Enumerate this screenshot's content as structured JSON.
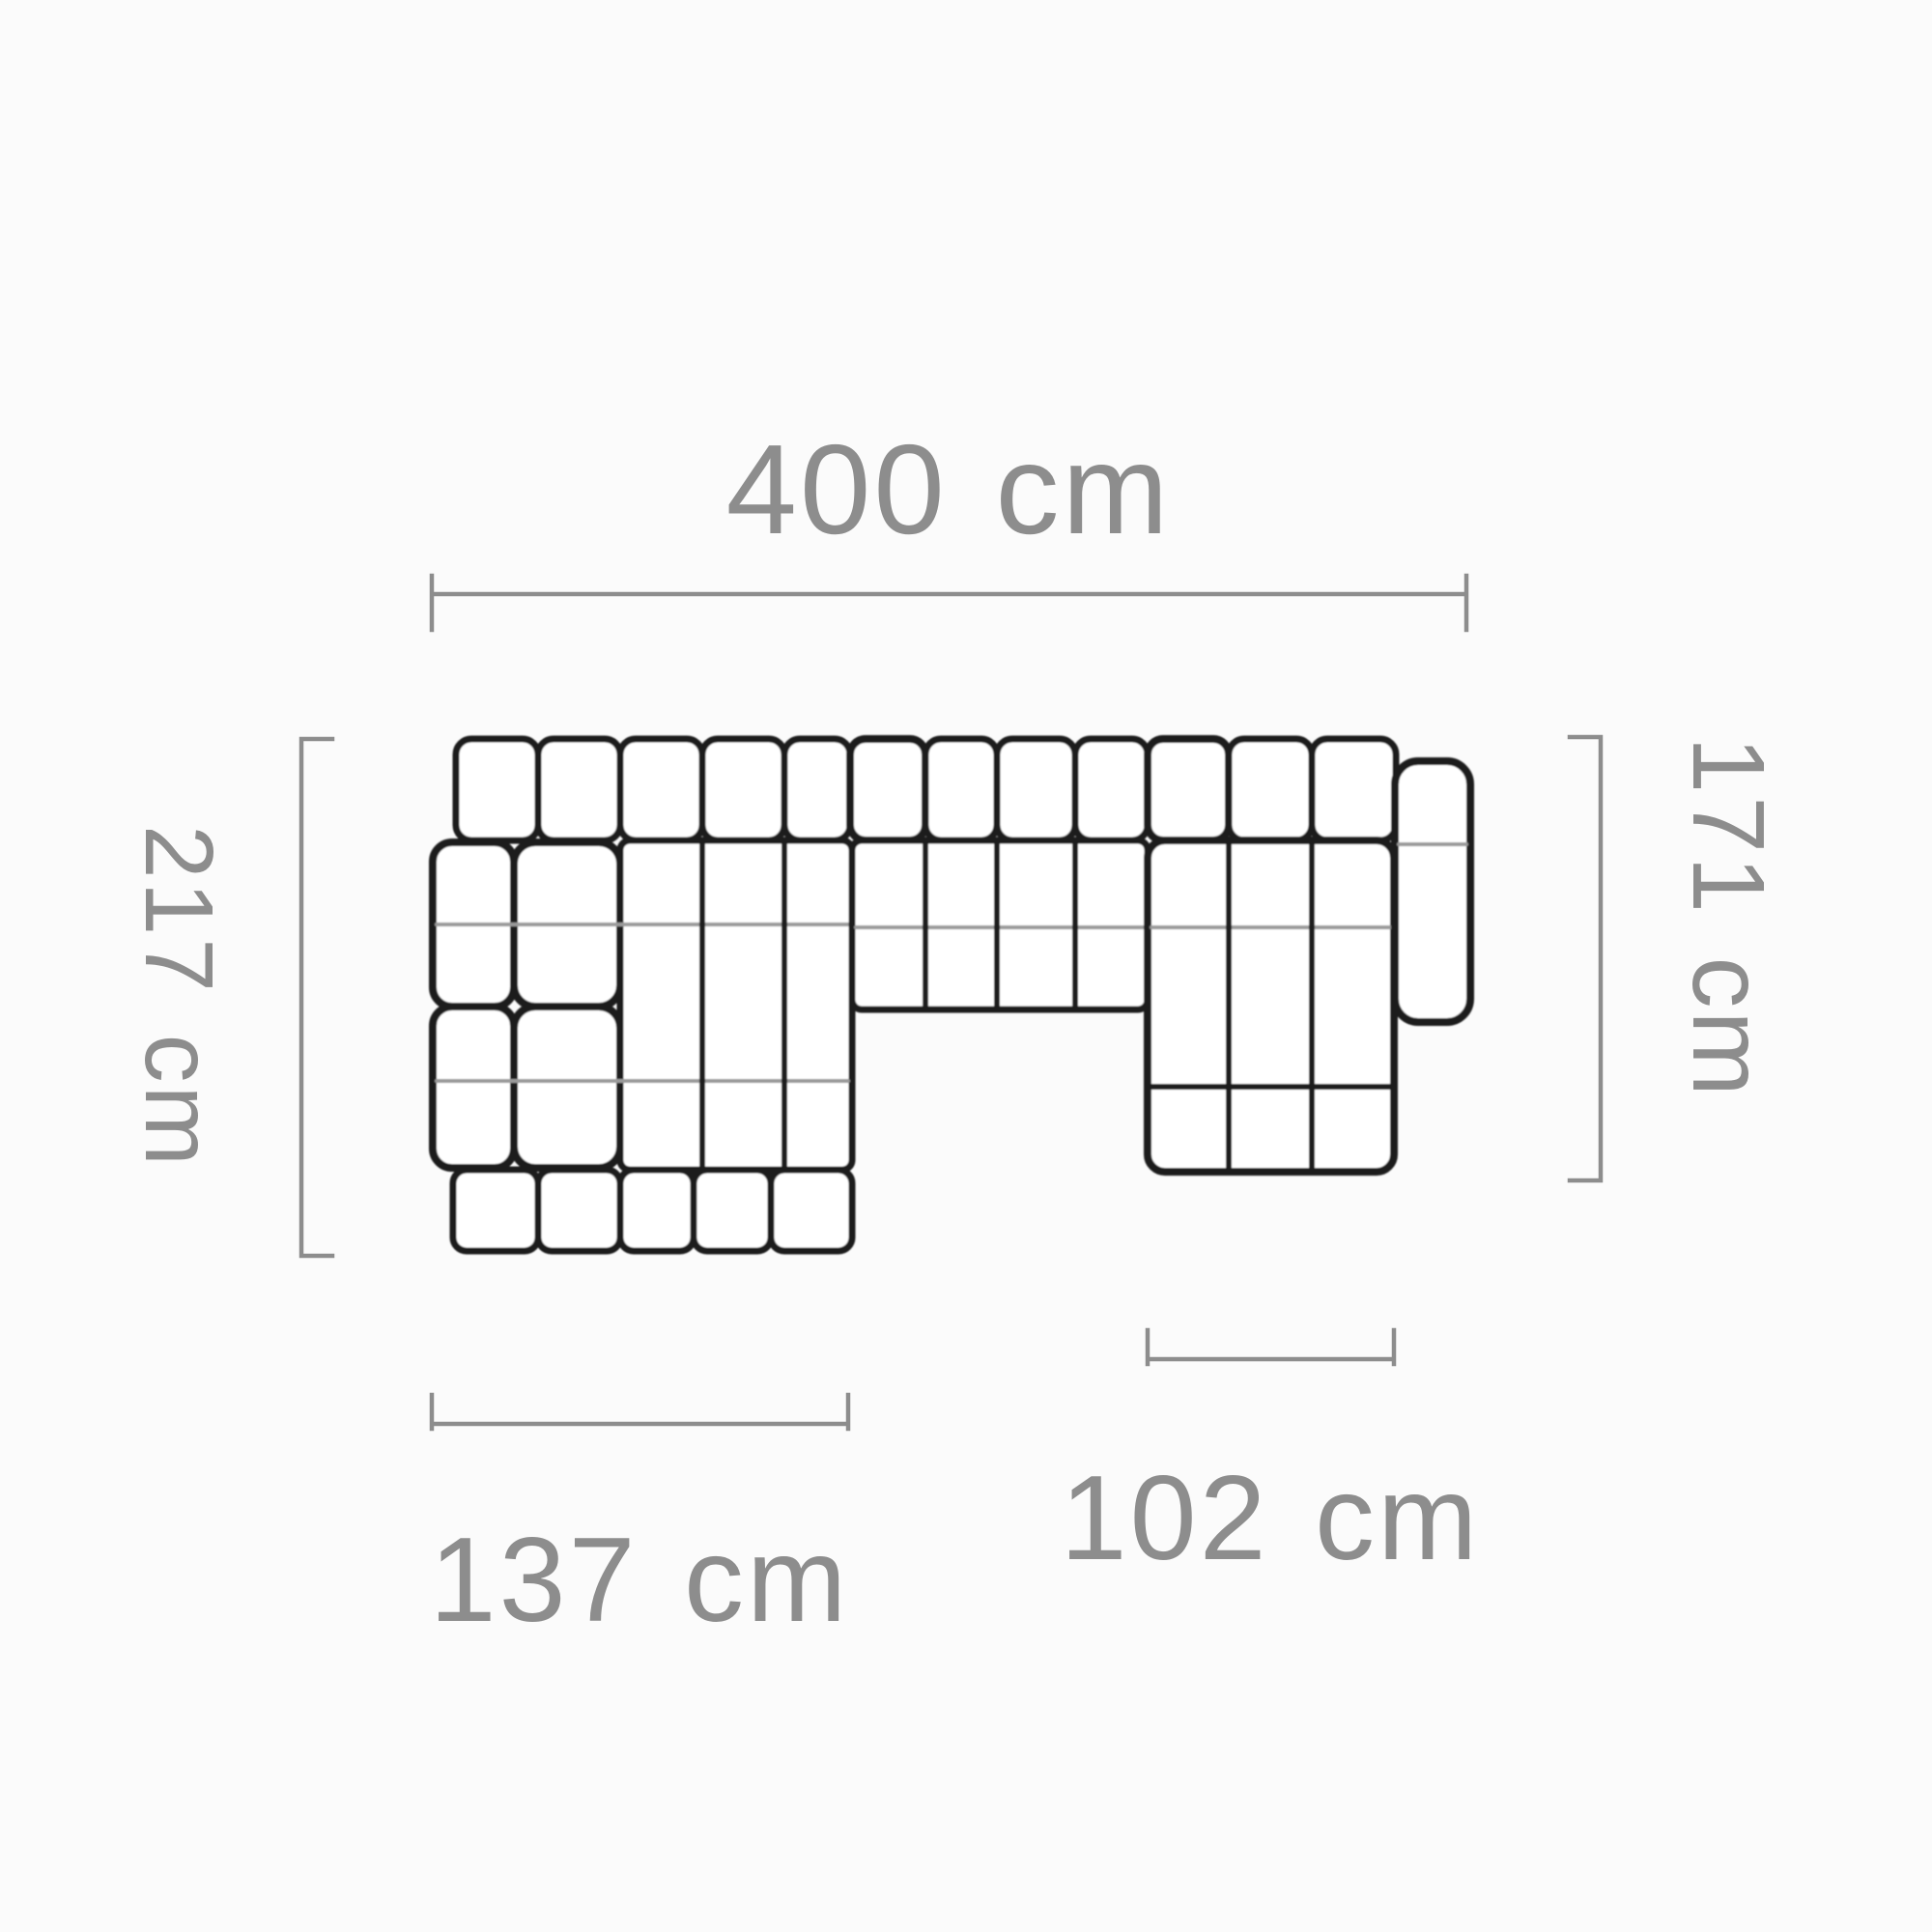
{
  "diagram": {
    "title": "sofa-top-view-dimension-diagram",
    "unit": "cm",
    "labels": {
      "total_width": "400 cm",
      "left_depth": "217 cm",
      "right_depth": "171 cm",
      "left_chaise_width": "137 cm",
      "right_chaise_width": "102 cm"
    },
    "values": {
      "total_width": 400,
      "left_depth": 217,
      "right_depth": 171,
      "left_chaise_width": 137,
      "right_chaise_width": 102
    },
    "colors": {
      "sofa_outline": "#1b1b1b",
      "cushion_crease": "#9a9a9a",
      "dimension": "#8d8d8d",
      "background": "#fbfbfb"
    }
  }
}
